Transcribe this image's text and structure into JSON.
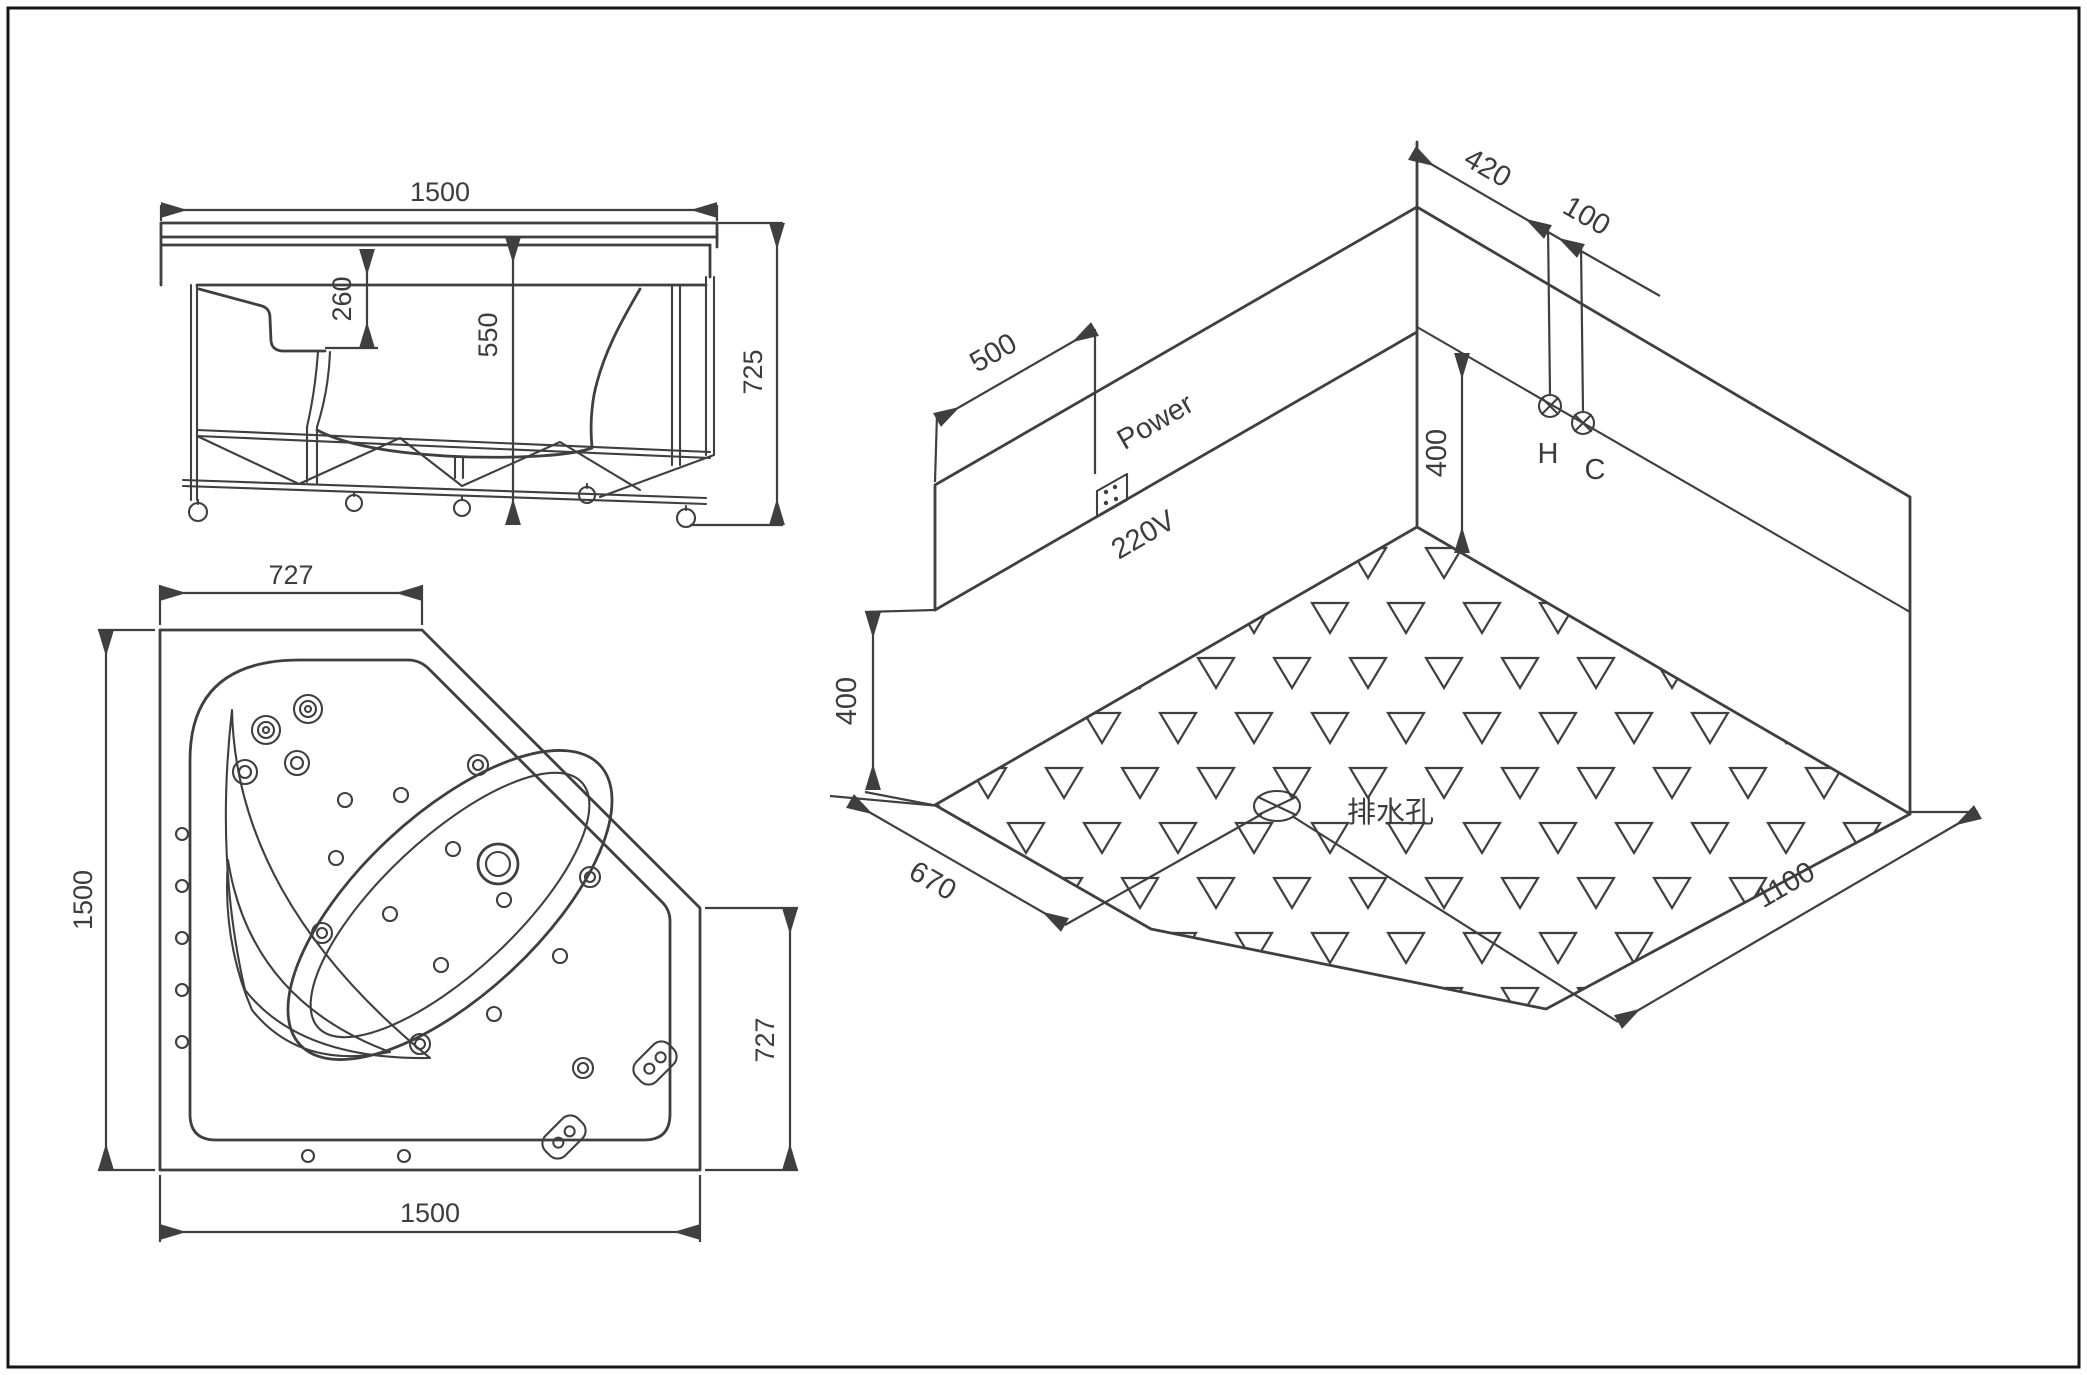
{
  "drawing": {
    "type": "technical installation drawing, corner whirlpool bathtub",
    "line_color": "#3f3f3f",
    "background": "#ffffff",
    "front_view": {
      "width": "1500",
      "rim_to_seat_depth": "260",
      "rim_to_frame_bottom": "550",
      "overall_height": "725"
    },
    "plan_view": {
      "top_edge": "727",
      "left_edge": "1500",
      "bottom_edge": "1500",
      "right_edge": "727"
    },
    "iso_view": {
      "corner_to_hot": "420",
      "hot_to_cold": "100",
      "wall_to_socket": "500",
      "socket_height": "400",
      "supply_height": "400",
      "floor_edge_left": "670",
      "floor_edge_right": "1100",
      "power_label": "Power",
      "voltage_label": "220V",
      "hot_label": "H",
      "cold_label": "C",
      "drain_label": "排水孔"
    }
  }
}
